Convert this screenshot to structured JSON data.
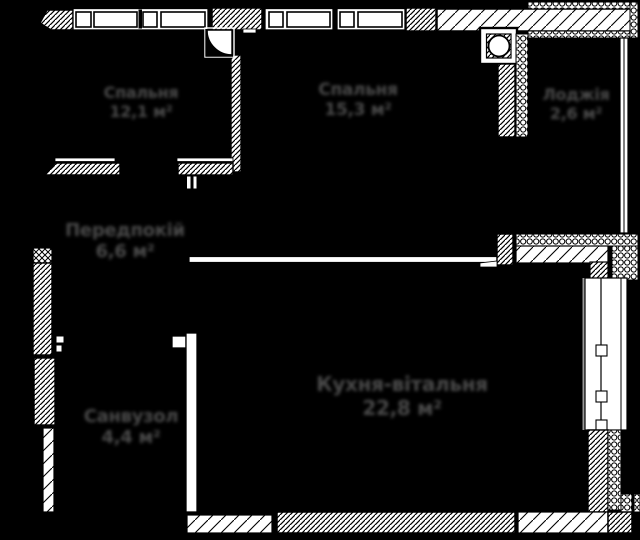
{
  "plan": {
    "type": "apartment-floor-plan",
    "background_color": "#000000",
    "wall_fill_color": "#ffffff",
    "wall_line_color": "#000000",
    "label_color": "#4a4a4a",
    "rooms": [
      {
        "id": "bedroom",
        "label": "Спальня",
        "area": "12,1 м²"
      },
      {
        "id": "bedroom-2",
        "label": "Спальня",
        "area": "15,3 м²"
      },
      {
        "id": "loggia",
        "label": "Лоджія",
        "area": "2,6 м²"
      },
      {
        "id": "hallway",
        "label": "Передпокій",
        "area": "6,6 м²"
      },
      {
        "id": "bathroom",
        "label": "Санвузол",
        "area": "4,4 м²"
      },
      {
        "id": "kitchen-living",
        "label": "Кухня-вітальня",
        "area": "22,8 м²"
      }
    ]
  }
}
